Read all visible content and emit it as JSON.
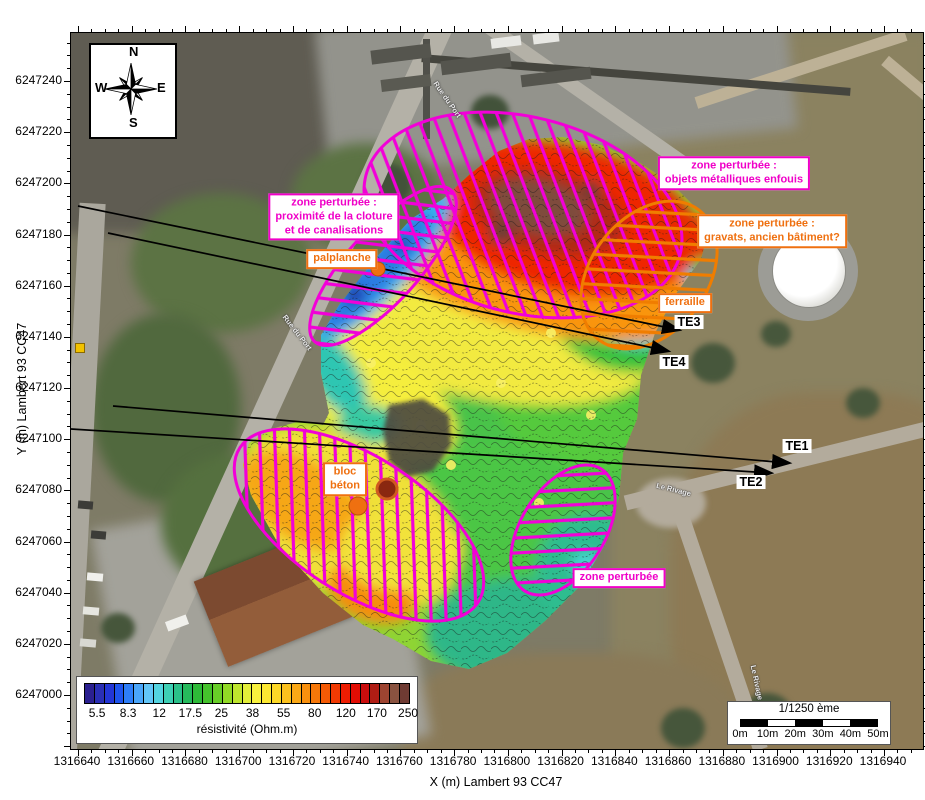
{
  "axes": {
    "x_title": "X (m) Lambert 93 CC47",
    "y_title": "Y (m) Lambert 93 CC47",
    "x_tick_labels": [
      "1316640",
      "1316660",
      "1316680",
      "1316700",
      "1316720",
      "1316740",
      "1316760",
      "1316780",
      "1316800",
      "1316820",
      "1316840",
      "1316860",
      "1316880",
      "1316900",
      "1316920",
      "1316940"
    ],
    "y_tick_labels": [
      "6247240",
      "6247220",
      "6247200",
      "6247180",
      "6247160",
      "6247140",
      "6247120",
      "6247100",
      "6247080",
      "6247060",
      "6247040",
      "6247020",
      "6247000"
    ]
  },
  "compass": {
    "north": "N",
    "east": "E",
    "south": "S",
    "west": "W"
  },
  "colorbar": {
    "title": "résistivité (Ohm.m)",
    "tick_labels": [
      "5.5",
      "8.3",
      "12",
      "17.5",
      "25",
      "38",
      "55",
      "80",
      "120",
      "170",
      "250"
    ],
    "cell_colors": [
      "#2b2090",
      "#2a2fb5",
      "#2336d6",
      "#1e55ee",
      "#2e7ef8",
      "#4ba6fa",
      "#63c6f8",
      "#54d4e0",
      "#3ecfb4",
      "#2bc089",
      "#26ba5c",
      "#2eba38",
      "#45c22c",
      "#68ce28",
      "#92da26",
      "#bfe62e",
      "#e3ee3a",
      "#f8f13e",
      "#fce832",
      "#fcd827",
      "#fbc11e",
      "#faa816",
      "#f8900e",
      "#f67709",
      "#f45a05",
      "#f13a03",
      "#ed1d02",
      "#e20d04",
      "#ca0d0d",
      "#b01d14",
      "#9e4431",
      "#8a5340",
      "#6f3b33"
    ]
  },
  "scalebar": {
    "ratio": "1/1250 ème",
    "tick_labels": [
      "0m",
      "10m",
      "20m",
      "30m",
      "40m",
      "50m"
    ],
    "segment_colors": [
      "#000000",
      "#ffffff",
      "#000000",
      "#ffffff",
      "#000000"
    ]
  },
  "annotations": {
    "zone_cloture": {
      "lines": [
        "zone perturbée :",
        "proximité de la cloture",
        "et de canalisations"
      ],
      "color": "#f000c8"
    },
    "palplanche": {
      "lines": [
        "palplanche"
      ],
      "color": "#ef7010"
    },
    "zone_metal": {
      "lines": [
        "zone perturbée :",
        "objets métalliques enfouis"
      ],
      "color": "#f000c8"
    },
    "zone_gravats": {
      "lines": [
        "zone perturbée :",
        "gravats, ancien bâtiment?"
      ],
      "color": "#ef7010"
    },
    "ferraille": {
      "lines": [
        "ferraille"
      ],
      "color": "#ef7010"
    },
    "bloc_beton": {
      "lines": [
        "bloc",
        "béton"
      ],
      "color": "#ef7010"
    },
    "zone_perturbee": {
      "lines": [
        "zone perturbée"
      ],
      "color": "#f000c8"
    }
  },
  "transect_labels": {
    "te1": "TE1",
    "te2": "TE2",
    "te3": "TE3",
    "te4": "TE4"
  },
  "road_labels": [
    "Rue du Port",
    "Rue du Port",
    "Le Rivage",
    "Le Rivage"
  ],
  "theme": {
    "magenta": "#f000c8",
    "orange": "#ef7010",
    "hatch_magenta": "#f200d8",
    "hatch_orange": "#f07d00",
    "arrow": "#000000"
  }
}
